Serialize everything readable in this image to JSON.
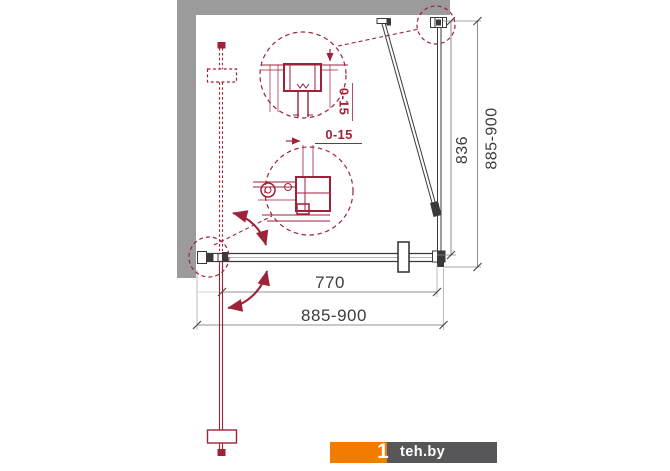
{
  "drawing": {
    "dimension_labels": {
      "panel_height": "836",
      "overall_height": "885-900",
      "door_width": "770",
      "overall_width": "885-900",
      "top_adjustment": "0-15",
      "side_adjustment": "0-15"
    },
    "colors": {
      "red": "#9e2238",
      "black": "#3a3a3a",
      "wall_gray": "#9b9b9b",
      "dim_gray": "#777777"
    }
  },
  "watermark": {
    "mark": "1",
    "name": "teh.by",
    "orange": "#f17c00",
    "dark_gray": "#57575a"
  }
}
